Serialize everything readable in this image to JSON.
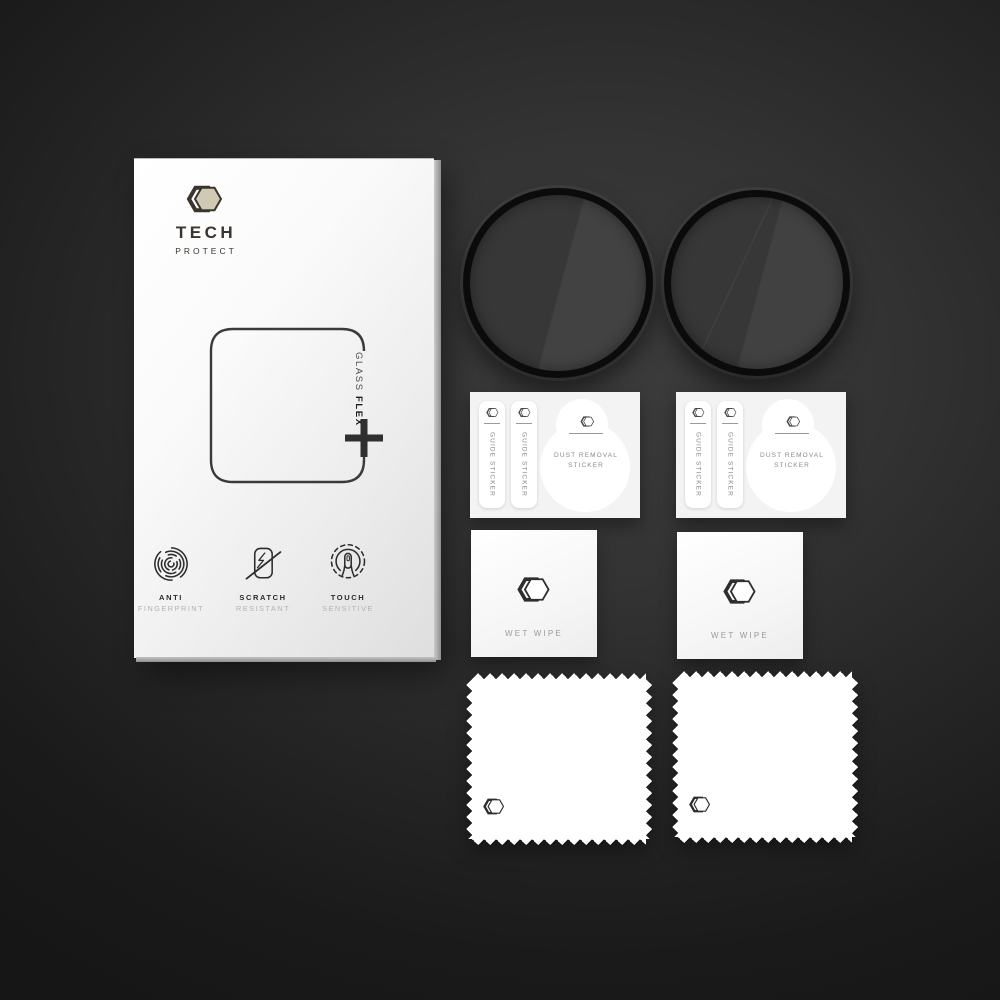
{
  "package": {
    "brand": {
      "name": "TECH",
      "subname": "PROTECT",
      "logo_icon": "hexagon-logo-icon",
      "panel_color": "#d0cab5",
      "text_color": "#3a352c"
    },
    "product": {
      "line1": "GLASS",
      "line2": "FLEX",
      "plus_icon": "plus-icon"
    },
    "features": [
      {
        "icon": "fingerprint-icon",
        "title": "ANTI",
        "subtitle": "FINGERPRINT"
      },
      {
        "icon": "scratch-resistant-icon",
        "title": "SCRATCH",
        "subtitle": "RESISTANT"
      },
      {
        "icon": "touch-sensitive-icon",
        "title": "TOUCH",
        "subtitle": "SENSITIVE"
      }
    ]
  },
  "accessories": {
    "glass_discs": {
      "count": 2,
      "face_color": "#3d3d3d",
      "rim_color": "#0b0b0b"
    },
    "sticker_sheet": {
      "guide_sticker_label": "GUIDE STICKER",
      "dust_removal_line1": "DUST REMOVAL",
      "dust_removal_line2": "STICKER",
      "logo_icon": "hexagon-logo-icon"
    },
    "wet_wipe": {
      "label": "WET WIPE",
      "logo_icon": "hexagon-logo-icon"
    },
    "cloth": {
      "logo_icon": "hexagon-logo-icon"
    }
  },
  "scene": {
    "background_color": "#262626",
    "package_color": "#f2f2f2"
  }
}
